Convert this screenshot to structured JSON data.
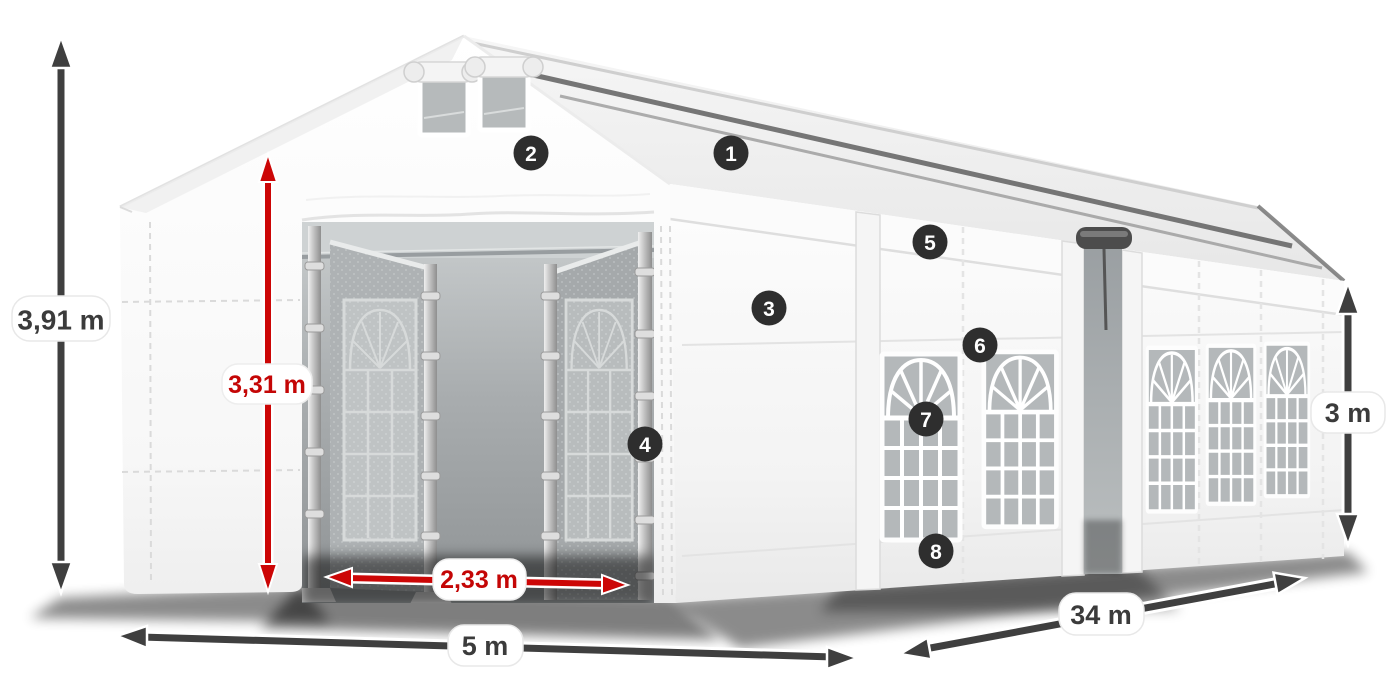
{
  "illustration": {
    "subject": "white party tent (marquee) with open front entrance doors, gable windows and arched side windows",
    "view": "front-left perspective product render on white background"
  },
  "colors": {
    "dimension_gray": "#3f3f3f",
    "dimension_red": "#cc0606",
    "pill_background": "#ffffff",
    "pill_text_gray": "#3b3b3b",
    "pill_text_red": "#c40606",
    "badge_background": "#2e2e2e",
    "badge_text": "#ffffff",
    "tent_white": "#ffffff",
    "window_glass_gray": "#b4b8ba"
  },
  "dimensions": {
    "total_height": {
      "label": "3,91 m",
      "color": "gray",
      "orientation": "vertical-left"
    },
    "entrance_height": {
      "label": "3,31 m",
      "color": "red",
      "orientation": "vertical-entrance"
    },
    "entrance_width": {
      "label": "2,33 m",
      "color": "red",
      "orientation": "horizontal-entrance"
    },
    "tent_width": {
      "label": "5 m",
      "color": "gray",
      "orientation": "horizontal-front"
    },
    "tent_length": {
      "label": "34 m",
      "color": "gray",
      "orientation": "diagonal-side"
    },
    "side_height": {
      "label": "3 m",
      "color": "gray",
      "orientation": "vertical-right"
    }
  },
  "hotspots": [
    {
      "number": "1"
    },
    {
      "number": "2"
    },
    {
      "number": "3"
    },
    {
      "number": "4"
    },
    {
      "number": "5"
    },
    {
      "number": "6"
    },
    {
      "number": "7"
    },
    {
      "number": "8"
    }
  ]
}
